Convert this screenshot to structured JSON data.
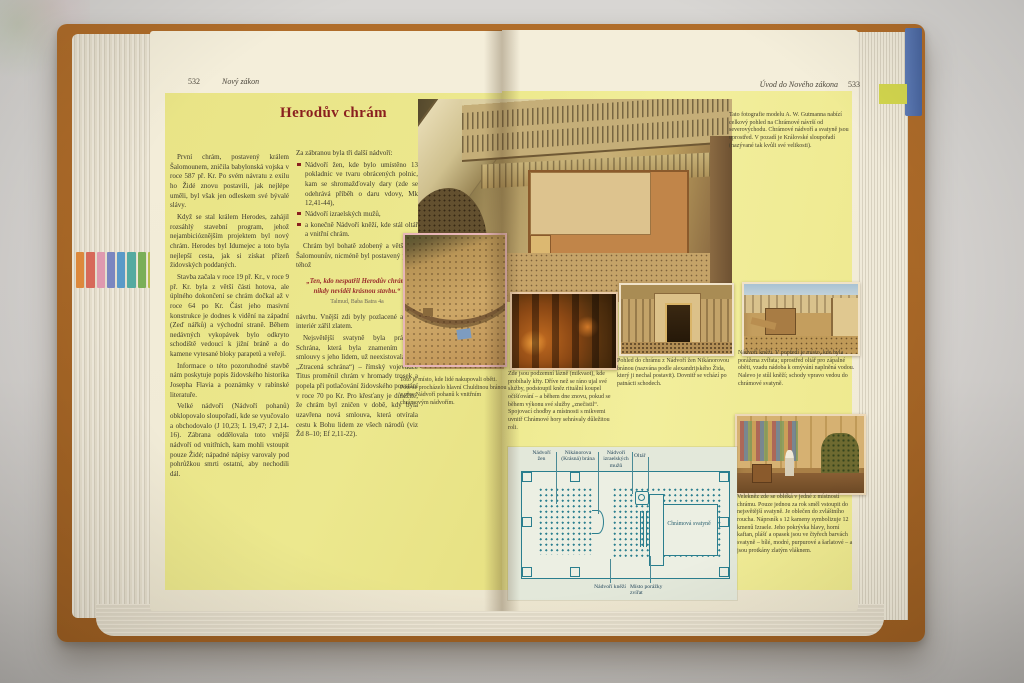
{
  "book": {
    "left_page": {
      "page_number": "532",
      "running_header": "Nový zákon",
      "title": "Herodův chrám",
      "col1": [
        "První chrám, postavený králem Šalomounem, zničila babylonská vojska v roce 587 př. Kr. Po svém návratu z exilu ho Židé znovu postavili, jak nejlépe uměli, byl však jen odleskem své bývalé slávy.",
        "Když se stal králem Herodes, zahájil rozsáhlý stavební program, jehož nejambicióznějším projektem byl nový chrám. Herodes byl Idumejec a toto byla nejlepší cesta, jak si získat přízeň židovských poddaných.",
        "Stavba začala v roce 19 př. Kr., v roce 9 př. Kr. byla z větší části hotova, ale úplného dokončení se chrám dočkal až v roce 64 po Kr. Část jeho masivní konstrukce je dodnes k vidění na západní (Zeď nářků) a východní straně. Během nedávných vykopávek bylo odkryto schodiště vedoucí k jižní bráně a do kamene vytesané bloky parapetů a veřejí.",
        "Informace o této pozoruhodné stavbě nám poskytuje popis židovského historika Josepha Flavia a poznámky v rabínské literatuře.",
        "Velké nádvoří (Nádvoří pohanů) obklopovalo sloupořadí, kde se vyučovalo a obchodovalo (J 10,23; L 19,47; J 2,14-16). Zábrana oddělovala toto vnější nádvoří od vnitřních, kam mohli vstoupit pouze Židé; nápadné nápisy varovaly pod pohrůžkou smrti ostatní, aby nechodili dál."
      ],
      "col2_intro": "Za zábranou byla tři další nádvoří:",
      "bullets": [
        "Nádvoří žen, kde bylo umístěno 13 pokladnic ve tvaru obrácených polnic, kam se shromažďovaly dary (zde se odehrává příběh o daru vdovy, Mk 12,41-44),",
        "Nádvoří izraelských mužů,",
        "a konečně Nádvoří kněží, kde stál oltář a vnitřní chrám."
      ],
      "col2_after": "Chrám byl bohatě zdobený a větší než Šalomounův, nicméně byl postavený podle téhož",
      "quote": "„Ten, kdo nespatřil Herodův chrám, nikdy neviděl krásnou stavbu.“",
      "quote_attribution": "Talmud, Baba Batra 4a",
      "col2b": [
        "návrhu. Vnější zdi byly pozlacené a také interiér zářil zlatem.",
        "Nejsvětější svatyně byla prázdná. Schrána, která byla znamením Boží smlouvy s jeho lidem, už neexistovala (viz „Ztracená schrána“) – římský vojevůdce Titus proměnil chrám v hromady trosek a popela při potlačování židovského povstání v roce 70 po Kr. Pro křesťany je důležité, že chrám byl zničen v době, kdy byla uzavřena nová smlouva, která otvírala cestu k Bohu lidem ze všech národů (viz Žd 8–10; Ef 2,11-22)."
      ]
    },
    "right_page": {
      "running_header": "Úvod do Nového zákona",
      "page_number": "533",
      "model_caption": "Tato fotografie modelu A. W. Gutmanna nabízí celkový pohled na Chrámové návrší od severovýchodu. Chrámové nádvoří a svatyně jsou uprostřed. V pozadí je Královské sloupořadí (nazývané tak kvůli své velikosti).",
      "captions": {
        "market": "Toto je místo, kde lidé nakupovali oběti. Poté se procházelo hlavní Chuldinou bránou a přes Nádvoří pohanů k vnitřním chrámovým nádvořím.",
        "mikveh": "Zde jsou podzemní lázně (mikvaot), kde probíhaly křty. Dříve než se ráno ujal své služby, podstoupil kněz rituální koupel očišťování – a během dne znovu, pokud se během výkonu své služby „znečistil“. Spojovací chodby a místnosti s mikvemi uvnitř Chrámové hory sehrávaly důležitou roli.",
        "gate": "Pohled do chrámu z Nádvoří žen Nikánorovou bránou (nazvána podle alexandrijského Žida, který ji nechal postavit). Dovnitř se vchází po patnácti schodech.",
        "priests": "Nádvoří kněží. V popředí je místo, kde byla porážena zvířata; uprostřed oltář pro zápalné oběti, vzadu nádoba k omývání naplněná vodou. Nalevo je stůl kněží; schody vpravo vedou do chrámové svatyně.",
        "robing": "Velekněz zde se obléká v jedné z místností chrámu. Pouze jednou za rok směl vstoupit do nejsvětější svatyně. Je oblečen do zvláštního roucha. Náprsník s 12 kameny symbolizuje 12 kmenů Izraele. Jeho pokrývka hlavy, horní kaftan, plášť a opasek jsou ve čtyřech barvách svatyně – bílé, modré, purpurové a šarlatové – a jsou protkány zlatým vláknem."
      },
      "plan": {
        "label_women": "Nádvoří žen",
        "label_nicanor": "Nikánorova (Krásná) brána",
        "label_israel": "Nádvoří izraelských mužů",
        "label_altar": "Oltář",
        "label_priests": "Nádvoří kněží",
        "label_slaughter": "Místo porážky zvířat",
        "label_sanctuary": "Chrámová svatyně"
      }
    },
    "colors": {
      "cover": "#a8692a",
      "panel_yellow": "#eee98f",
      "title_red": "#8a1f1f",
      "plan_teal": "#2a7e8e",
      "paper": "#f2ecd9"
    }
  }
}
